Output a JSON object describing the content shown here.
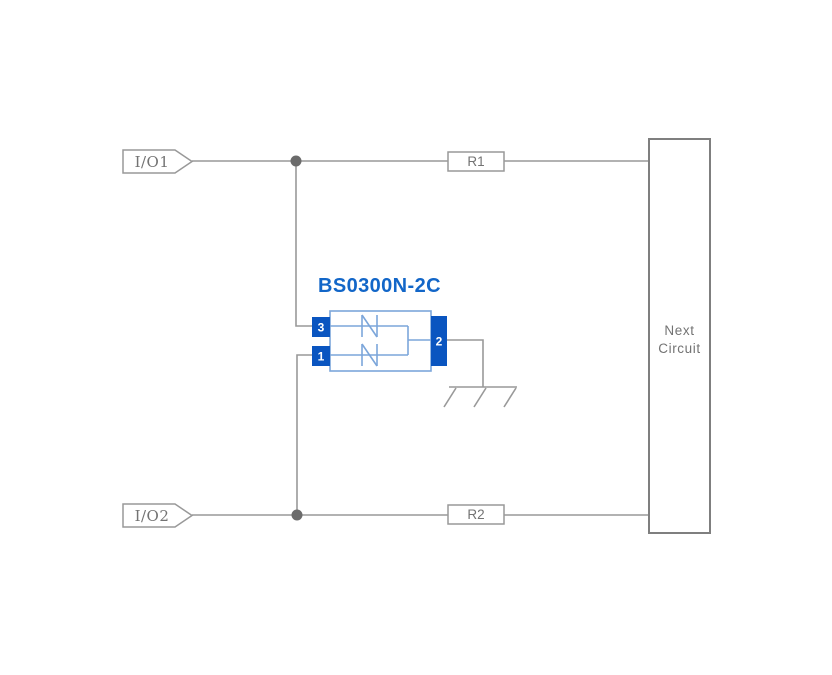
{
  "diagram": {
    "type": "circuit-schematic",
    "component": {
      "title": "BS0300N-2C",
      "pins": [
        {
          "number": "3"
        },
        {
          "number": "1"
        },
        {
          "number": "2"
        }
      ],
      "internal_elements": "two bidirectional TVS diodes to common pin 2 (grounded)"
    },
    "inputs": [
      {
        "label": "I/O1"
      },
      {
        "label": "I/O2"
      }
    ],
    "resistors": [
      {
        "label": "R1"
      },
      {
        "label": "R2"
      }
    ],
    "next_circuit": {
      "line1": "Next",
      "line2": "Circuit"
    },
    "colors": {
      "wire": "#999999",
      "wire_dark": "#7f7f7f",
      "junction_dot": "#6b6b6b",
      "text_gray": "#737373",
      "pin_blue": "#0a55c0",
      "body_blue": "#7ca6da",
      "title_blue": "#1266c8"
    }
  }
}
